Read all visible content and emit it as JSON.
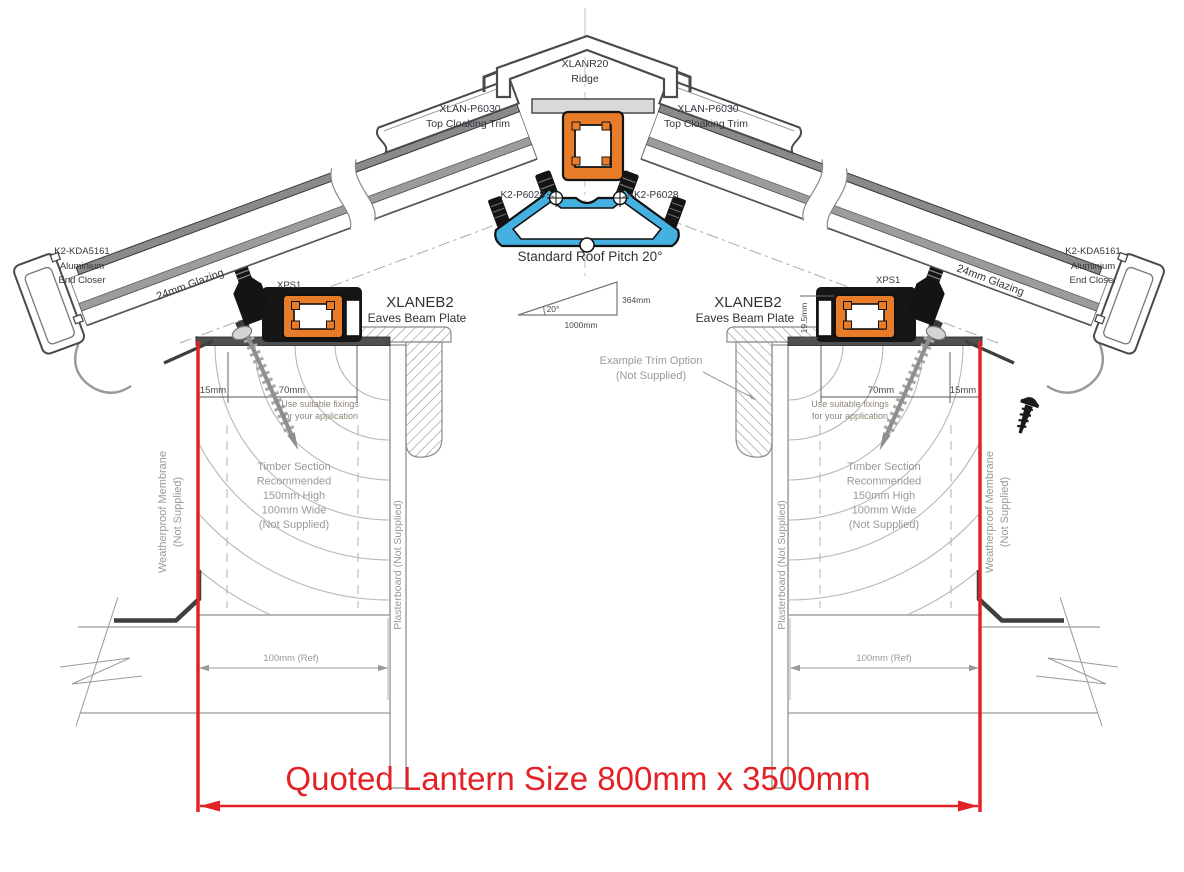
{
  "drawing": {
    "title": "Roof lantern cross section installation drawing",
    "ridge": {
      "model": "XLANR20",
      "name": "Ridge"
    },
    "cloaking_trim": {
      "model": "XLAN-P6030",
      "name": "Top Cloaking Trim"
    },
    "glazing_bar_fixing": {
      "model": "K2-P6028"
    },
    "pitch_note": "Standard Roof Pitch 20°",
    "pitch_triangle": {
      "angle": "20°",
      "rise": "364mm",
      "run": "1000mm"
    },
    "eaves_beam": {
      "model": "XLANEB2",
      "name": "Eaves Beam Plate"
    },
    "xps": "XPS1",
    "end_closer": {
      "line1": "K2-KDA5161",
      "line2": "Aluminium",
      "line3": "End Closer"
    },
    "glazing": "24mm Glazing",
    "dims": {
      "d15": "15mm",
      "d70": "70mm",
      "d19_5": "19.5mm",
      "d100": "100mm (Ref)"
    },
    "fixings_note": {
      "line1": "Use suitable fixings",
      "line2": "for your application"
    },
    "timber_note": {
      "line1": "Timber Section",
      "line2": "Recommended",
      "line3": "150mm High",
      "line4": "100mm Wide",
      "line5": "(Not Supplied)"
    },
    "membrane_note": {
      "line1": "Weatherproof Membrane",
      "line2": "(Not Supplied)"
    },
    "plasterboard_note": "Plasterboard (Not Supplied)",
    "trim_option_note": {
      "line1": "Example  Trim Option",
      "line2": "(Not Supplied)"
    },
    "quoted_size": "Quoted Lantern Size 800mm x 3500mm",
    "colors": {
      "accent_red": "#e32227",
      "profile_orange": "#e87c28",
      "profile_blue": "#45b1e0"
    }
  }
}
